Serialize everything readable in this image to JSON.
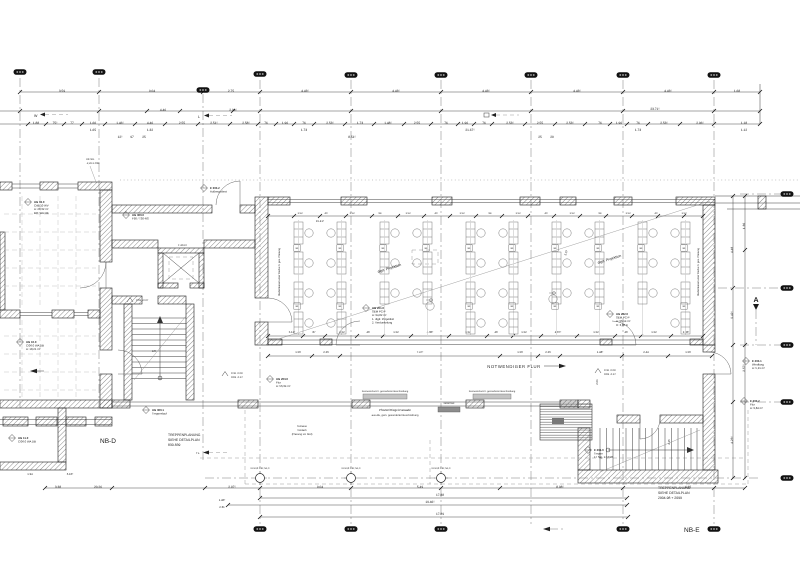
{
  "key_labels": {
    "nb_d": "NB-D",
    "nb_e": "NB-E",
    "corridor": "NOTWENDIGER FLUR",
    "section_marker": "A"
  },
  "notes": {
    "stair_note_left": [
      "TREPPENPLANUNG",
      "SIEHE DETAILPLAN",
      "830-839"
    ],
    "stair_note_right": [
      "TREPPENPLANUNG",
      "SIEHE DETAILPLAN",
      "2904-98 + 2099"
    ]
  },
  "labels": [
    {
      "x": 378,
      "y": 273,
      "t": "digit. Projektion",
      "s": 3.6,
      "r": -17.5
    },
    {
      "x": 598,
      "y": 264,
      "t": "digit. Projektion",
      "s": 3.6,
      "r": -17.5
    },
    {
      "x": 280,
      "y": 272,
      "t": "Medienkanal unter Decke lt. ges. Planung",
      "s": 2.6,
      "r": -90,
      "a": "middle"
    },
    {
      "x": 699,
      "y": 272,
      "t": "Medienkanal unter Decke lt. ges. Planung",
      "s": 2.6,
      "r": -90,
      "a": "middle"
    },
    {
      "x": 385,
      "y": 392,
      "t": "Sonnenschutz lt. gesonderter Beschreibung",
      "s": 2.4,
      "a": "middle"
    },
    {
      "x": 492,
      "y": 392,
      "t": "Sonnenschutz lt. gesonderter Beschreibung",
      "s": 2.4,
      "a": "middle"
    },
    {
      "x": 395,
      "y": 411,
      "t": "Pfosten/Riegel-Fassade",
      "s": 3,
      "a": "middle"
    },
    {
      "x": 395,
      "y": 416,
      "t": "aus Alu, gem. gesonderter Beschreibung",
      "s": 2.6,
      "a": "middle"
    },
    {
      "x": 302,
      "y": 427,
      "t": "Terrasse",
      "s": 2.6,
      "a": "middle"
    },
    {
      "x": 302,
      "y": 431,
      "t": "Vordach",
      "s": 2.6,
      "a": "middle"
    },
    {
      "x": 302,
      "y": 435,
      "t": "(Planung LH Süd)",
      "s": 2.6,
      "a": "middle"
    },
    {
      "x": 449,
      "y": 404,
      "t": "Gitterrost",
      "s": 2.6,
      "a": "middle"
    },
    {
      "x": 86,
      "y": 160,
      "t": "UK Stz.",
      "s": 2.6
    },
    {
      "x": 86,
      "y": 164,
      "t": "-2,26 ü.OKF",
      "s": 2.6
    },
    {
      "x": 152,
      "y": 352,
      "t": "LR",
      "s": 3
    },
    {
      "x": 196,
      "y": 454,
      "t": "TL.",
      "s": 2.8
    },
    {
      "x": 34,
      "y": 117,
      "t": "W",
      "s": 3.6
    },
    {
      "x": 198,
      "y": 118,
      "t": "L",
      "s": 3.6
    },
    {
      "x": 604,
      "y": 371,
      "t": "FFB -0.08",
      "s": 2.6
    },
    {
      "x": 604,
      "y": 375,
      "t": "RFB -0.37",
      "s": 2.6
    },
    {
      "x": 231,
      "y": 374,
      "t": "FFB -0.08",
      "s": 2.6
    },
    {
      "x": 231,
      "y": 378,
      "t": "RFB -0.37",
      "s": 2.6
    },
    {
      "x": 136,
      "y": 301,
      "t": "PTB +0.07",
      "s": 2.6
    },
    {
      "x": 178,
      "y": 246,
      "t": "F 403.0",
      "s": 2.6
    }
  ],
  "stamps": [
    {
      "x": 28,
      "y": 202,
      "l": [
        "UG 03.0",
        "C4B.10 WV",
        "A: 28,32 m²",
        "BO: WA DB"
      ]
    },
    {
      "x": 20,
      "y": 342,
      "l": [
        "UG 10.0",
        "C/06.0 WA DB",
        "A: 18,21 m²"
      ]
    },
    {
      "x": 12,
      "y": 438,
      "l": [
        "UG 11.0",
        "C/06.0 WA DB"
      ]
    },
    {
      "x": 126,
      "y": 215,
      "l": [
        "UG 300.0",
        "F90 / T30-RS"
      ]
    },
    {
      "x": 204,
      "y": 188,
      "l": [
        "E 303.2",
        "Außenpodest"
      ]
    },
    {
      "x": 366,
      "y": 308,
      "l": [
        "UG 201.0",
        "SEM PC-P",
        "A: 94,82 m²",
        "1. digit. Projektion",
        "2. Verdunkelung"
      ]
    },
    {
      "x": 610,
      "y": 314,
      "l": [
        "UG 202.0",
        "SEM PC-P",
        "A: 96,14 m²",
        "H: 3,06 m"
      ]
    },
    {
      "x": 270,
      "y": 379,
      "l": [
        "UG 203.0",
        "Flur",
        "A: 56,34 m²"
      ]
    },
    {
      "x": 146,
      "y": 410,
      "l": [
        "UG 300.1",
        "Treppenlauf"
      ]
    },
    {
      "x": 588,
      "y": 450,
      "l": [
        "E 204.0",
        "Treppe",
        "17 Stg. 17,6/28"
      ]
    },
    {
      "x": 746,
      "y": 361,
      "l": [
        "E 203.1",
        "Windfang",
        "A: 5,21 m²"
      ]
    },
    {
      "x": 744,
      "y": 401,
      "l": [
        "E 203.2",
        "Flur",
        "A: 9,84 m²"
      ]
    }
  ],
  "dims": [
    [
      62,
      92,
      "3.59"
    ],
    [
      152,
      92,
      "9.04"
    ],
    [
      231,
      92,
      "2.75"
    ],
    [
      305,
      92,
      "4.43⁵"
    ],
    [
      396,
      92,
      "4.43⁵"
    ],
    [
      486,
      92,
      "4.43⁵"
    ],
    [
      577,
      92,
      "4.43⁵"
    ],
    [
      668,
      92,
      "4.43⁵"
    ],
    [
      737,
      92,
      "1.68"
    ],
    [
      163,
      111,
      "4.46"
    ],
    [
      233,
      111,
      "2.96⁵"
    ],
    [
      655,
      110,
      "23.71⁵"
    ],
    [
      36,
      124,
      "1.88"
    ],
    [
      55,
      124,
      "75⁵"
    ],
    [
      72,
      124,
      "77"
    ],
    [
      93,
      124,
      "1.60"
    ],
    [
      120,
      124,
      "1.46⁵"
    ],
    [
      150,
      124,
      "4.46"
    ],
    [
      182,
      124,
      "2.55"
    ],
    [
      214,
      124,
      "2.51⁵"
    ],
    [
      246,
      124,
      "2.58⁵"
    ],
    [
      266,
      124,
      "76"
    ],
    [
      285,
      124,
      "1.96"
    ],
    [
      304,
      124,
      "76"
    ],
    [
      330,
      124,
      "2.53⁵"
    ],
    [
      360,
      124,
      "1.73"
    ],
    [
      388,
      124,
      "1.48⁵"
    ],
    [
      417,
      124,
      "2.55"
    ],
    [
      446,
      124,
      "76"
    ],
    [
      465,
      124,
      "1.96"
    ],
    [
      484,
      124,
      "76"
    ],
    [
      510,
      124,
      "2.53⁵"
    ],
    [
      540,
      124,
      "2.55"
    ],
    [
      570,
      124,
      "2.53⁵"
    ],
    [
      600,
      124,
      "76"
    ],
    [
      619,
      124,
      "1.96"
    ],
    [
      638,
      124,
      "76"
    ],
    [
      664,
      124,
      "2.53⁵"
    ],
    [
      700,
      124,
      "2.96⁵"
    ],
    [
      744,
      124,
      "1.18"
    ],
    [
      93,
      131,
      "1.65"
    ],
    [
      150,
      131,
      "1.32"
    ],
    [
      304,
      131,
      "1.73"
    ],
    [
      470,
      131,
      "21.67⁵"
    ],
    [
      638,
      131,
      "1.73"
    ],
    [
      744,
      131,
      "1.12"
    ],
    [
      120,
      138,
      "12⁵"
    ],
    [
      132,
      138,
      "97"
    ],
    [
      144,
      138,
      "25"
    ],
    [
      352,
      138,
      "8.51⁵"
    ],
    [
      540,
      138,
      "25"
    ],
    [
      552,
      138,
      "20"
    ],
    [
      300,
      214,
      "1.52",
      0,
      2.6
    ],
    [
      326,
      214,
      "40",
      0,
      2.6
    ],
    [
      352,
      214,
      "1.52",
      0,
      2.6
    ],
    [
      380,
      214,
      "94",
      0,
      2.6
    ],
    [
      408,
      214,
      "1.52",
      0,
      2.6
    ],
    [
      436,
      214,
      "40",
      0,
      2.6
    ],
    [
      462,
      214,
      "1.52",
      0,
      2.6
    ],
    [
      490,
      214,
      "94",
      0,
      2.6
    ],
    [
      518,
      214,
      "1.52",
      0,
      2.6
    ],
    [
      546,
      214,
      "40",
      0,
      2.6
    ],
    [
      572,
      214,
      "1.52",
      0,
      2.6
    ],
    [
      600,
      214,
      "94",
      0,
      2.6
    ],
    [
      628,
      214,
      "1.52",
      0,
      2.6
    ],
    [
      656,
      214,
      "40",
      0,
      2.6
    ],
    [
      684,
      214,
      "1.52",
      0,
      2.6
    ],
    [
      320,
      222,
      "15.41⁵",
      0,
      2.8
    ],
    [
      292,
      333,
      "5.12⁵",
      0,
      2.8
    ],
    [
      314,
      333,
      "87",
      0,
      2.8
    ],
    [
      342,
      333,
      "1.52",
      0,
      2.8
    ],
    [
      368,
      333,
      "40",
      0,
      2.8
    ],
    [
      396,
      333,
      "1.52",
      0,
      2.8
    ],
    [
      430,
      333,
      "4.30⁵",
      0,
      2.8
    ],
    [
      468,
      333,
      "1.52",
      0,
      2.8
    ],
    [
      496,
      333,
      "40",
      0,
      2.8
    ],
    [
      524,
      333,
      "1.52",
      0,
      2.8
    ],
    [
      558,
      333,
      "4.07⁵",
      0,
      2.8
    ],
    [
      596,
      333,
      "1.52",
      0,
      2.8
    ],
    [
      626,
      333,
      "40",
      0,
      2.8
    ],
    [
      654,
      333,
      "1.52",
      0,
      2.8
    ],
    [
      686,
      333,
      "2.86⁵",
      0,
      2.8
    ],
    [
      298,
      353,
      "1.50",
      0,
      2.8
    ],
    [
      326,
      353,
      "2.26",
      0,
      2.8
    ],
    [
      420,
      353,
      "7.47⁵",
      0,
      2.8
    ],
    [
      520,
      353,
      "1.50",
      0,
      2.8
    ],
    [
      548,
      353,
      "2.26",
      0,
      2.8
    ],
    [
      600,
      353,
      "1.48⁵",
      0,
      2.8
    ],
    [
      646,
      353,
      "2.44",
      0,
      2.8
    ],
    [
      688,
      353,
      "1.50",
      0,
      2.8
    ],
    [
      58,
      488,
      "3.38"
    ],
    [
      98,
      488,
      "20.26"
    ],
    [
      232,
      488,
      "2.97⁵"
    ],
    [
      320,
      488,
      "9.04"
    ],
    [
      420,
      488,
      "5.49"
    ],
    [
      560,
      488,
      "8.98⁵"
    ],
    [
      688,
      488,
      "4.12"
    ],
    [
      440,
      496,
      "17.88"
    ],
    [
      430,
      503,
      "19.46⁵"
    ],
    [
      440,
      515,
      "17.89"
    ],
    [
      222,
      501,
      "1.40⁵",
      0,
      2.8
    ],
    [
      222,
      508,
      "2.31",
      0,
      2.8
    ],
    [
      30,
      475,
      "1.94",
      0,
      2.8
    ],
    [
      70,
      475,
      "6.10⁵",
      0,
      2.8
    ],
    [
      733,
      250,
      "4.48",
      -90
    ],
    [
      733,
      315,
      "9.42⁵",
      -90
    ],
    [
      733,
      440,
      "4.23⁵",
      -90
    ],
    [
      745,
      226,
      "1.36",
      -90
    ],
    [
      745,
      368,
      "2.57⁵",
      -90
    ],
    [
      598,
      382,
      "2.01",
      -90,
      2.8
    ],
    [
      670,
      442,
      "4.15",
      -90,
      2.8
    ],
    [
      567,
      253,
      "5.07",
      -73,
      2.8
    ]
  ],
  "chains": [
    {
      "y": 92,
      "x1": 20,
      "x2": 760,
      "ticks": [
        20,
        99,
        203,
        260,
        351,
        441,
        531,
        623,
        714,
        760
      ]
    },
    {
      "y": 111,
      "x1": 0,
      "x2": 760,
      "ticks": [
        20,
        99,
        147,
        180,
        233,
        260,
        351,
        441,
        531,
        623,
        714,
        760
      ]
    },
    {
      "y": 124,
      "x1": 0,
      "x2": 760,
      "ticks": [
        28,
        46,
        64,
        82,
        105,
        135,
        165,
        198,
        230,
        258,
        276,
        294,
        314,
        345,
        374,
        404,
        431,
        458,
        474,
        492,
        525,
        555,
        585,
        610,
        627,
        648,
        680,
        714,
        760
      ]
    },
    {
      "y": 216,
      "x1": 268,
      "x2": 703,
      "ticks": [
        268,
        294,
        320,
        346,
        372,
        398,
        424,
        450,
        476,
        502,
        528,
        554,
        580,
        606,
        632,
        658,
        684,
        703
      ]
    },
    {
      "y": 336,
      "x1": 268,
      "x2": 703,
      "ticks": [
        268,
        303,
        325,
        357,
        383,
        411,
        449,
        487,
        513,
        541,
        577,
        615,
        641,
        671,
        703
      ]
    },
    {
      "y": 356,
      "x1": 268,
      "x2": 712,
      "ticks": [
        268,
        312,
        340,
        500,
        538,
        560,
        622,
        668,
        712
      ]
    },
    {
      "y": 488,
      "x1": 45,
      "x2": 745,
      "ticks": [
        45,
        112,
        205,
        260,
        351,
        441,
        500,
        623,
        714,
        745
      ]
    },
    {
      "y": 498,
      "x1": 260,
      "x2": 627,
      "ticks": [
        260,
        627
      ]
    },
    {
      "y": 505,
      "x1": 228,
      "x2": 627,
      "ticks": [
        228,
        627
      ]
    },
    {
      "y": 517,
      "x1": 260,
      "x2": 628,
      "ticks": [
        260,
        628
      ]
    },
    {
      "x": 733,
      "y1": 196,
      "y2": 478,
      "ticks": [
        196,
        288,
        345,
        402,
        478
      ],
      "v": 1
    },
    {
      "x": 745,
      "y1": 196,
      "y2": 478,
      "ticks": [
        196,
        250,
        345,
        478
      ],
      "v": 1
    }
  ],
  "bubbles": {
    "top": [
      [
        20,
        72
      ],
      [
        99,
        72
      ],
      [
        203,
        90
      ],
      [
        260,
        74
      ],
      [
        351,
        75
      ],
      [
        441,
        75
      ],
      [
        531,
        75
      ],
      [
        623,
        75
      ],
      [
        714,
        75
      ]
    ],
    "bottom": [
      [
        260,
        529
      ],
      [
        351,
        529
      ],
      [
        441,
        529
      ],
      [
        623,
        529
      ],
      [
        714,
        529
      ]
    ],
    "right": [
      [
        787,
        194
      ],
      [
        787,
        288
      ],
      [
        787,
        345
      ],
      [
        787,
        402
      ],
      [
        787,
        478
      ]
    ]
  },
  "columns": {
    "points": [
      [
        260,
        478
      ],
      [
        351,
        478
      ],
      [
        441,
        478
      ]
    ],
    "label": "FLSt Ø 139,7x4,0"
  },
  "desks": {
    "rows": [
      222,
      252,
      282,
      312
    ],
    "cols": [
      294,
      337,
      380,
      423,
      466,
      509,
      552,
      595,
      638,
      681
    ],
    "skip": [
      [
        312,
        380
      ],
      [
        312,
        423
      ],
      [
        312,
        552
      ],
      [
        312,
        595
      ],
      [
        312,
        638
      ]
    ]
  },
  "squares": {
    "ys": [
      248,
      306
    ],
    "xs": [
      297,
      340,
      383,
      426,
      469,
      512,
      555,
      598,
      641,
      684
    ],
    "skip": [
      [
        306,
        383
      ],
      [
        306,
        426
      ],
      [
        306,
        641
      ]
    ],
    "label": "84"
  },
  "wheelchairs": [
    [
      430,
      306
    ],
    [
      553,
      299
    ]
  ],
  "colors": {
    "ink": "#1b1b1b",
    "dim": "#2e2e2e",
    "glass_bar": "#c4c4c4",
    "grate_bar": "#8d8d8d",
    "paper": "#ffffff"
  }
}
